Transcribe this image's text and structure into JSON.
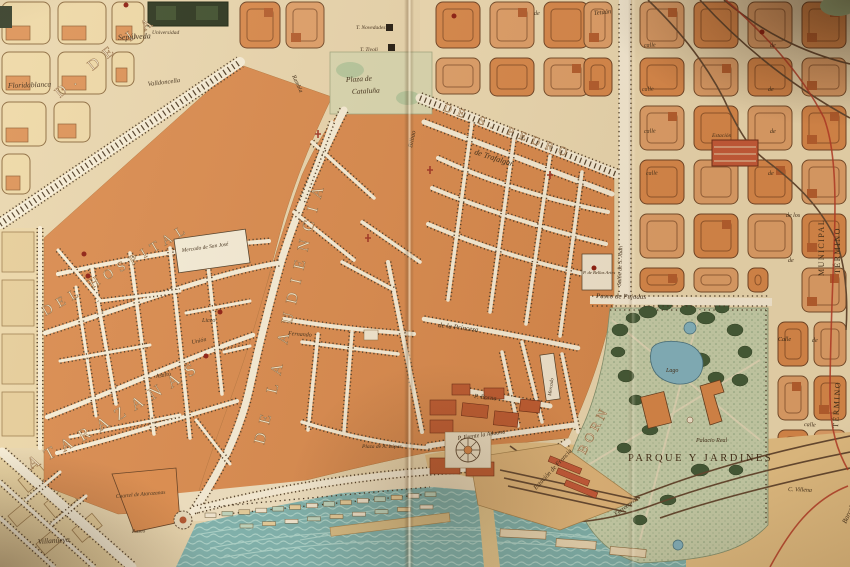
{
  "colors": {
    "paper": "#e9d8b2",
    "district_orange": "#d98a4f",
    "block_pale": "#eedaaa",
    "block_orange": "#d8884c",
    "park_green": "#c6d2b0",
    "water_teal": "#7ab4b3",
    "boundary_red": "#b33626",
    "ink": "#3a2a18"
  },
  "big_labels": {
    "ronda_universidad": "D. DE LA U",
    "hospital": "DEL HOSPITAL",
    "atarazanas": "ATARAZANAS",
    "audiencia": "DE LA AUDIENCIA",
    "san_pedro": "DE S. PEDRO",
    "born": "BORN",
    "parque": "PARQUE Y JARDINES",
    "municipal": "MUNICIPAL",
    "termino": "TÉRMINO",
    "barcelona": "Barcelona"
  },
  "streets": {
    "sepulveda": "Sepúlveda",
    "floridablanca": "Floridablanca",
    "valldoncella": "Valldoncella",
    "trafalgar": "de Trafalgar",
    "princesa": "de la Princesa",
    "borne": "P. Borne",
    "bilbao": "Bilbao",
    "tetuan": "Tetuán",
    "rambla": "Rambla",
    "asalto": "Asalto",
    "union": "Unión",
    "fernando": "Fernando",
    "aduana": "P. Frente la Aduana",
    "pujadas": "Paseo de Pujadas",
    "villanueva": "Villanueva",
    "paseo": "Paseo",
    "villena": "C. Villena",
    "ferrocarril": "Ferrocarril",
    "salon": "Salón de S. Juan",
    "calle": "calle",
    "calle_cap": "Calle",
    "de": "de",
    "de_los": "de los"
  },
  "places": {
    "plaza_cataluna_line1": "Plaza de",
    "plaza_cataluna_line2": "Cataluña",
    "mercado_san_jose": "Mercado de San José",
    "universidad": "Universidad",
    "liceo": "Liceo",
    "tivoli": "T. Tivoli",
    "novedades": "T. Novedades",
    "cuartel": "Cuartel de Atarazanas",
    "estacion_francia": "Estación de Francia",
    "estacion": "Estación",
    "lago": "Lago",
    "palacio_real": "Palacio Real",
    "bellas_artes": "P. de Bellas Artes",
    "plaza_lopez": "Plaza de A. López",
    "mercado_born": "Mercado"
  }
}
